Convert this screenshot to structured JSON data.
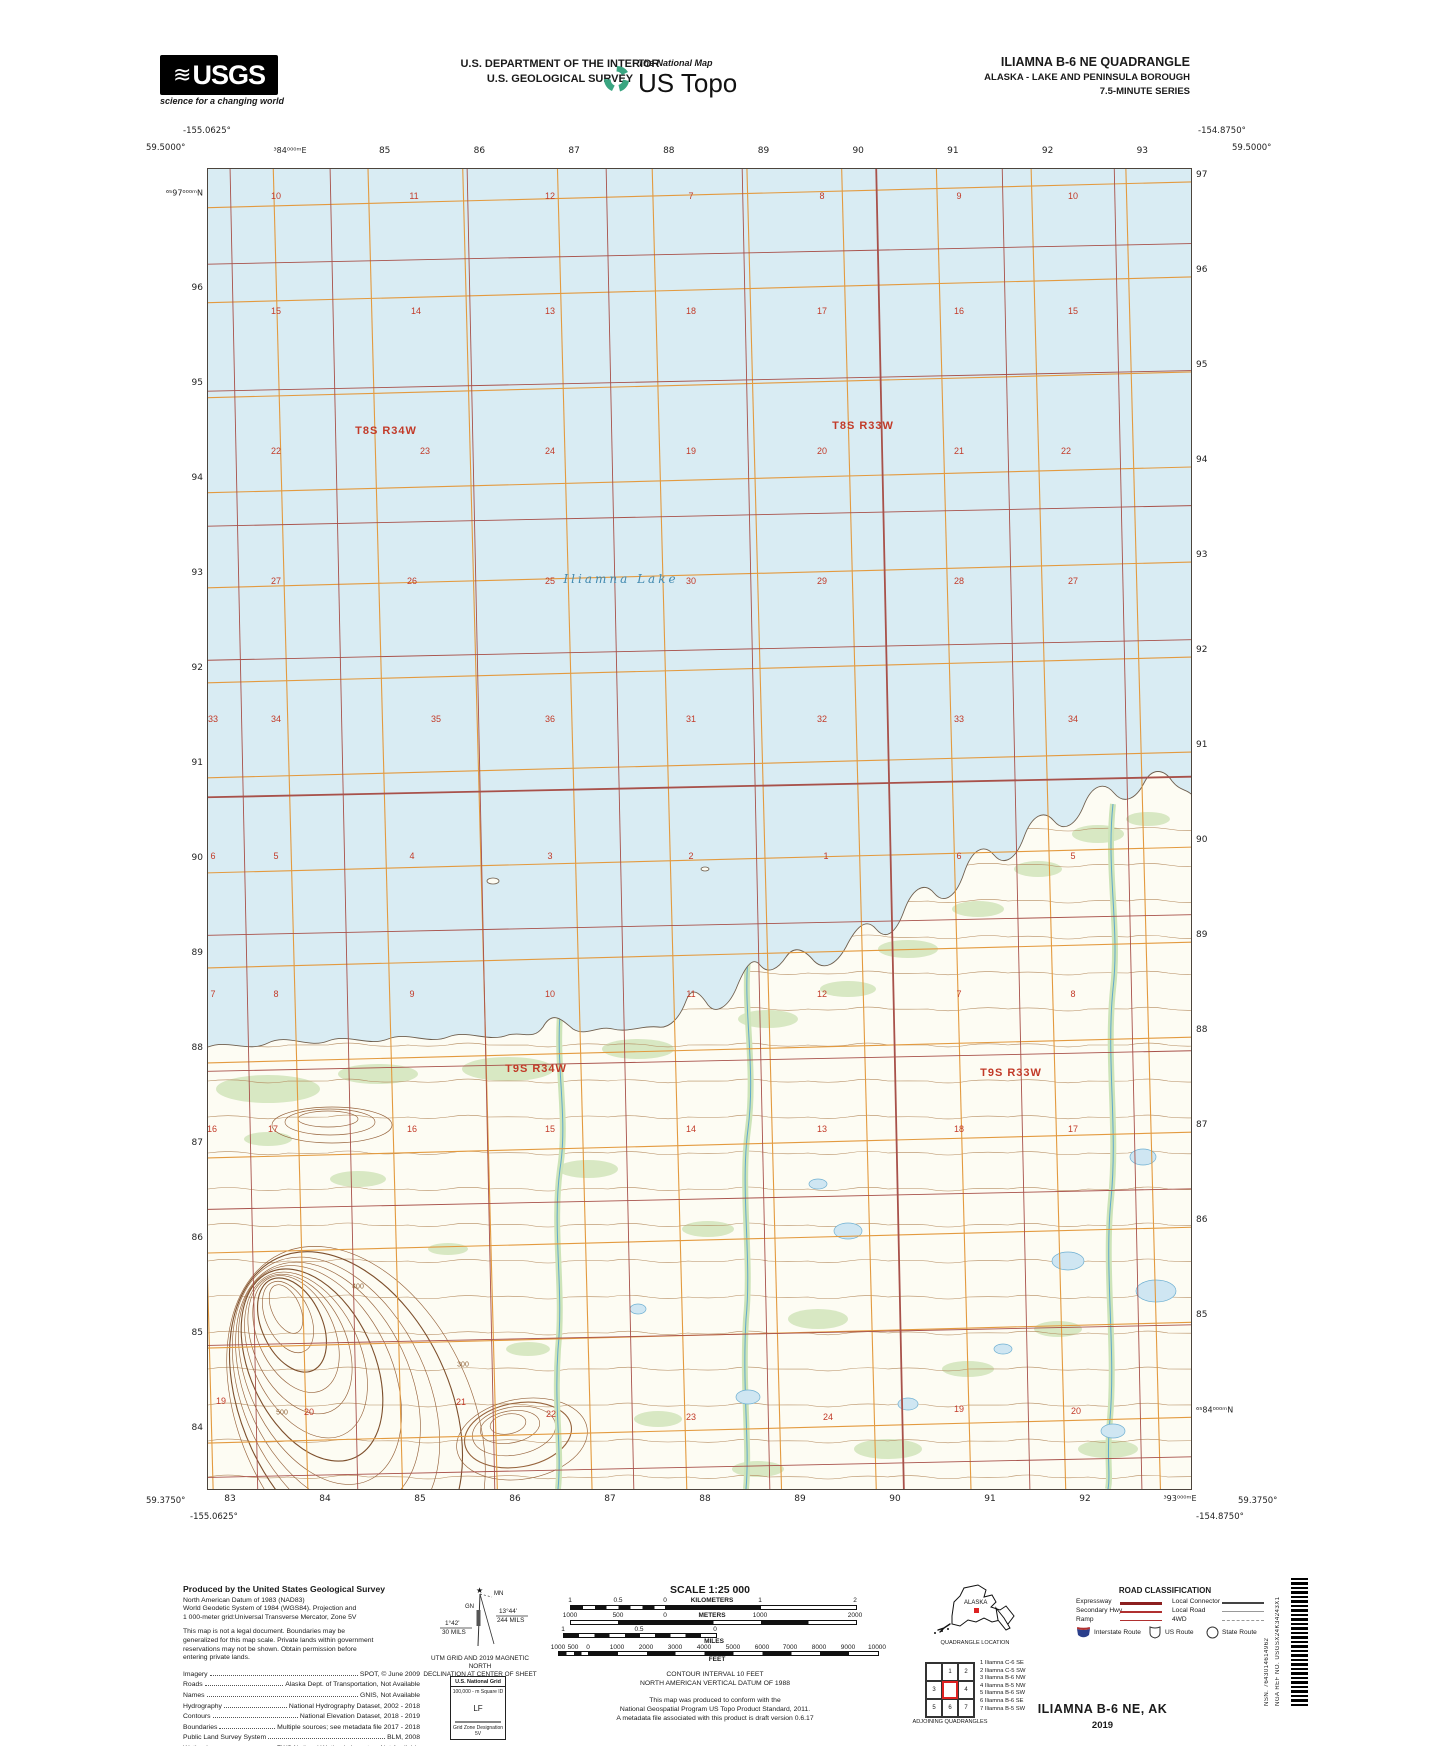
{
  "header": {
    "usgs_logo": {
      "text": "USGS",
      "wave": "≋",
      "tagline": "science for a changing world"
    },
    "department_line1": "U.S. DEPARTMENT OF THE INTERIOR",
    "department_line2": "U.S. GEOLOGICAL SURVEY",
    "ustopo": {
      "brand": "The National Map",
      "product": "US Topo"
    },
    "quad_title": "ILIAMNA B-6 NE QUADRANGLE",
    "quad_subtitle": "ALASKA - LAKE AND PENINSULA BOROUGH",
    "quad_series": "7.5-MINUTE SERIES"
  },
  "map": {
    "corners": {
      "top_left_lon": "-155.0625°",
      "top_left_lat": "59.5000°",
      "top_right_lon": "-154.8750°",
      "top_right_lat": "59.5000°",
      "bottom_left_lat": "59.3750°",
      "bottom_left_lon": "-155.0625°",
      "bottom_right_lon": "-154.8750°",
      "bottom_right_lat": "59.3750°"
    },
    "top_eastings": [
      "³84⁰⁰⁰ᵐE",
      "85",
      "86",
      "87",
      "88",
      "89",
      "90",
      "91",
      "92",
      "93"
    ],
    "bottom_eastings": [
      "83",
      "84",
      "85",
      "86",
      "87",
      "88",
      "89",
      "90",
      "91",
      "92",
      "³93⁰⁰⁰ᵐE"
    ],
    "left_northings": [
      "⁶⁵97⁰⁰⁰ᵐN",
      "96",
      "95",
      "94",
      "93",
      "92",
      "91",
      "90",
      "89",
      "88",
      "87",
      "86",
      "85",
      "84"
    ],
    "right_northings": [
      "97",
      "96",
      "95",
      "94",
      "93",
      "92",
      "91",
      "90",
      "89",
      "88",
      "87",
      "86",
      "85",
      "⁶⁵84⁰⁰⁰ᵐN"
    ],
    "lake_label": "Iliamna Lake",
    "township_labels": [
      {
        "t": "T8S R34W",
        "x": 178,
        "y": 262
      },
      {
        "t": "T8S R33W",
        "x": 655,
        "y": 257
      },
      {
        "t": "T9S R34W",
        "x": 328,
        "y": 900
      },
      {
        "t": "T9S R33W",
        "x": 803,
        "y": 904
      }
    ],
    "contour_labels": [
      {
        "t": "400",
        "x": 150,
        "y": 1118
      },
      {
        "t": "300",
        "x": 255,
        "y": 1196
      },
      {
        "t": "500",
        "x": 74,
        "y": 1244
      }
    ],
    "section_numbers": [
      {
        "x": 68,
        "y": 27,
        "t": "10"
      },
      {
        "x": 206,
        "y": 27,
        "t": "11"
      },
      {
        "x": 342,
        "y": 27,
        "t": "12"
      },
      {
        "x": 483,
        "y": 27,
        "t": "7"
      },
      {
        "x": 614,
        "y": 27,
        "t": "8"
      },
      {
        "x": 751,
        "y": 27,
        "t": "9"
      },
      {
        "x": 865,
        "y": 27,
        "t": "10"
      },
      {
        "x": 68,
        "y": 142,
        "t": "15"
      },
      {
        "x": 208,
        "y": 142,
        "t": "14"
      },
      {
        "x": 342,
        "y": 142,
        "t": "13"
      },
      {
        "x": 483,
        "y": 142,
        "t": "18"
      },
      {
        "x": 614,
        "y": 142,
        "t": "17"
      },
      {
        "x": 751,
        "y": 142,
        "t": "16"
      },
      {
        "x": 865,
        "y": 142,
        "t": "15"
      },
      {
        "x": 68,
        "y": 282,
        "t": "22"
      },
      {
        "x": 217,
        "y": 282,
        "t": "23"
      },
      {
        "x": 342,
        "y": 282,
        "t": "24"
      },
      {
        "x": 483,
        "y": 282,
        "t": "19"
      },
      {
        "x": 614,
        "y": 282,
        "t": "20"
      },
      {
        "x": 751,
        "y": 282,
        "t": "21"
      },
      {
        "x": 858,
        "y": 282,
        "t": "22"
      },
      {
        "x": 68,
        "y": 412,
        "t": "27"
      },
      {
        "x": 204,
        "y": 412,
        "t": "26"
      },
      {
        "x": 342,
        "y": 412,
        "t": "25"
      },
      {
        "x": 483,
        "y": 412,
        "t": "30"
      },
      {
        "x": 614,
        "y": 412,
        "t": "29"
      },
      {
        "x": 751,
        "y": 412,
        "t": "28"
      },
      {
        "x": 865,
        "y": 412,
        "t": "27"
      },
      {
        "x": 5,
        "y": 550,
        "t": "33"
      },
      {
        "x": 68,
        "y": 550,
        "t": "34"
      },
      {
        "x": 228,
        "y": 550,
        "t": "35"
      },
      {
        "x": 342,
        "y": 550,
        "t": "36"
      },
      {
        "x": 483,
        "y": 550,
        "t": "31"
      },
      {
        "x": 614,
        "y": 550,
        "t": "32"
      },
      {
        "x": 751,
        "y": 550,
        "t": "33"
      },
      {
        "x": 865,
        "y": 550,
        "t": "34"
      },
      {
        "x": 5,
        "y": 687,
        "t": "6"
      },
      {
        "x": 68,
        "y": 687,
        "t": "5"
      },
      {
        "x": 204,
        "y": 687,
        "t": "4"
      },
      {
        "x": 342,
        "y": 687,
        "t": "3"
      },
      {
        "x": 483,
        "y": 687,
        "t": "2"
      },
      {
        "x": 618,
        "y": 687,
        "t": "1"
      },
      {
        "x": 751,
        "y": 687,
        "t": "6"
      },
      {
        "x": 865,
        "y": 687,
        "t": "5"
      },
      {
        "x": 5,
        "y": 825,
        "t": "7"
      },
      {
        "x": 68,
        "y": 825,
        "t": "8"
      },
      {
        "x": 204,
        "y": 825,
        "t": "9"
      },
      {
        "x": 342,
        "y": 825,
        "t": "10"
      },
      {
        "x": 483,
        "y": 825,
        "t": "11"
      },
      {
        "x": 614,
        "y": 825,
        "t": "12"
      },
      {
        "x": 751,
        "y": 825,
        "t": "7"
      },
      {
        "x": 865,
        "y": 825,
        "t": "8"
      },
      {
        "x": 4,
        "y": 960,
        "t": "16"
      },
      {
        "x": 65,
        "y": 960,
        "t": "17"
      },
      {
        "x": 204,
        "y": 960,
        "t": "16"
      },
      {
        "x": 342,
        "y": 960,
        "t": "15"
      },
      {
        "x": 483,
        "y": 960,
        "t": "14"
      },
      {
        "x": 614,
        "y": 960,
        "t": "13"
      },
      {
        "x": 751,
        "y": 960,
        "t": "18"
      },
      {
        "x": 865,
        "y": 960,
        "t": "17"
      },
      {
        "x": 13,
        "y": 1232,
        "t": "19"
      },
      {
        "x": 101,
        "y": 1243,
        "t": "20"
      },
      {
        "x": 253,
        "y": 1233,
        "t": "21"
      },
      {
        "x": 343,
        "y": 1245,
        "t": "22"
      },
      {
        "x": 483,
        "y": 1248,
        "t": "23"
      },
      {
        "x": 620,
        "y": 1248,
        "t": "24"
      },
      {
        "x": 751,
        "y": 1240,
        "t": "19"
      },
      {
        "x": 868,
        "y": 1242,
        "t": "20"
      }
    ]
  },
  "footer": {
    "credits": {
      "heading": "Produced by the United States Geological Survey",
      "datum_lines": [
        "North American Datum of 1983 (NAD83)",
        "World Geodetic System of 1984 (WGS84).  Projection and",
        "1 000-meter grid:Universal Transverse Mercator, Zone 5V"
      ],
      "legal_lines": [
        "This map is not a legal document. Boundaries may be",
        "generalized for this map scale. Private lands within government",
        "reservations may not be shown. Obtain permission before",
        "entering private lands."
      ],
      "rows": [
        {
          "l": "Imagery",
          "r": "SPOT,  ©  June  2009"
        },
        {
          "l": "Roads",
          "r": "Alaska Dept. of Transportation, Not Available"
        },
        {
          "l": "Names",
          "r": "GNIS, Not Available"
        },
        {
          "l": "Hydrography",
          "r": "National Hydrography Dataset, 2002 - 2018"
        },
        {
          "l": "Contours",
          "r": "National Elevation Dataset, 2018 - 2019"
        },
        {
          "l": "Boundaries",
          "r": "Multiple sources; see metadata file 2017 - 2018"
        },
        {
          "l": "Public Land Survey System",
          "r": "BLM, 2008"
        },
        {
          "l": "Wetlands",
          "r": "FWS National Wetlands Inventory Not Available"
        }
      ]
    },
    "declination": {
      "star": "★",
      "gn": "GN",
      "mn": "MN",
      "gn_deg": "1°42'",
      "gn_mils": "30 MILS",
      "mn_deg": "13°44'",
      "mn_mils": "244 MILS",
      "caption1": "UTM GRID AND 2019 MAGNETIC NORTH",
      "caption2": "DECLINATION AT CENTER OF SHEET"
    },
    "usng": {
      "title": "U.S. National Grid",
      "sub": "100,000 - m Square ID",
      "square": "LF",
      "zone_label": "Grid Zone Designation",
      "zone": "5V"
    },
    "scale": {
      "title": "SCALE 1:25 000",
      "km_unit": "KILOMETERS",
      "m_unit": "METERS",
      "mi_unit": "MILES",
      "ft_unit": "FEET",
      "km_ticks": [
        "1",
        "0.5",
        "0",
        "1",
        "2"
      ],
      "m_ticks": [
        "1000",
        "500",
        "0",
        "1000",
        "2000"
      ],
      "mi_ticks": [
        "1",
        "0.5",
        "0"
      ],
      "ft_ticks": [
        "1000",
        "500",
        "0",
        "1000",
        "2000",
        "3000",
        "4000",
        "5000",
        "6000",
        "7000",
        "8000",
        "9000",
        "10000"
      ],
      "contour_note": "CONTOUR INTERVAL 10 FEET",
      "vdatum_note": "NORTH AMERICAN VERTICAL DATUM OF 1988",
      "conformance": [
        "This map was produced to conform with the",
        "National Geospatial Program US Topo Product Standard, 2011.",
        "A metadata file associated with this product is draft version 0.6.17"
      ]
    },
    "location": {
      "state": "ALASKA",
      "caption": "QUADRANGLE LOCATION"
    },
    "adjoining": {
      "cells": [
        "",
        "1",
        "2",
        "3",
        "",
        "4",
        "5",
        "6",
        "7"
      ],
      "caption": "ADJOINING QUADRANGLES",
      "list": [
        "1 Iliamna C-6 SE",
        "2 Iliamna C-5 SW",
        "3 Iliamna B-6 NW",
        "4 Iliamna B-5 NW",
        "5 Iliamna B-6 SW",
        "6 Iliamna B-6 SE",
        "7 Iliamna B-5 SW"
      ]
    },
    "roadclass": {
      "title": "ROAD CLASSIFICATION",
      "left_rows": [
        {
          "label": "Expressway",
          "color": "#8c1f1f",
          "w": 3,
          "dash": false
        },
        {
          "label": "Secondary Hwy",
          "color": "#b03030",
          "w": 2,
          "dash": false
        },
        {
          "label": "Ramp",
          "color": "#b03030",
          "w": 1,
          "dash": false
        }
      ],
      "right_rows": [
        {
          "label": "Local Connector",
          "color": "#444444",
          "w": 2,
          "dash": false
        },
        {
          "label": "Local Road",
          "color": "#999999",
          "w": 1,
          "dash": false
        },
        {
          "label": "4WD",
          "color": "#999999",
          "w": 1,
          "dash": true
        }
      ],
      "shields": [
        "Interstate Route",
        "US Route",
        "State Route"
      ]
    },
    "maptitle": {
      "name": "ILIAMNA B-6 NE,  AK",
      "year": "2019"
    },
    "barcode": {
      "nsn_label": "NSN.",
      "nsn": "7643014614962",
      "nga_label": "NGA REF NO.",
      "nga": "USGSX24K34243X1"
    }
  }
}
